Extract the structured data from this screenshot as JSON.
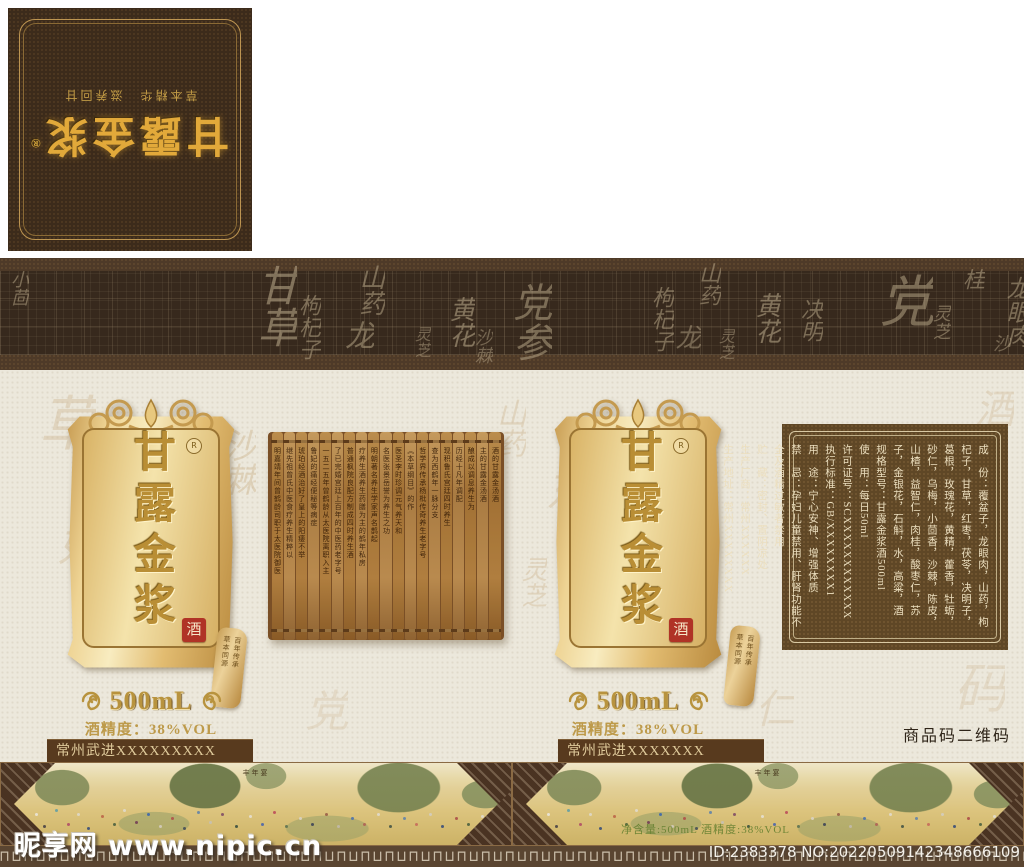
{
  "palette": {
    "gold": "#d2a347",
    "flap_brown": "#3c2b1b",
    "band_brown": "#4e3a28",
    "cream": "#ece8dc",
    "bar_brown": "#583a1e",
    "spec_brown": "#5f4726",
    "seal_red": "#b03326"
  },
  "top_flap": {
    "title": "甘露金浆",
    "registered": "®",
    "subtitle": "草本精华　滋养回甘"
  },
  "heritage": {
    "chars": [
      "百",
      "年",
      "传",
      "承"
    ],
    "subtext": "始于一六〇〇年",
    "seal": "鹤年堂"
  },
  "band_chars": [
    {
      "t": "小茴",
      "x": 6,
      "y": 12,
      "s": 18,
      "o": 0.5
    },
    {
      "t": "甘草",
      "x": 244,
      "y": 6,
      "s": 42,
      "o": 0.55
    },
    {
      "t": "枸杞子",
      "x": 292,
      "y": 36,
      "s": 22,
      "o": 0.5
    },
    {
      "t": "山药",
      "x": 352,
      "y": 6,
      "s": 26,
      "o": 0.5
    },
    {
      "t": "龙",
      "x": 334,
      "y": 62,
      "s": 30,
      "o": 0.5
    },
    {
      "t": "灵芝",
      "x": 408,
      "y": 68,
      "s": 16,
      "o": 0.45
    },
    {
      "t": "黄花",
      "x": 442,
      "y": 38,
      "s": 26,
      "o": 0.55
    },
    {
      "t": "党参",
      "x": 500,
      "y": 24,
      "s": 40,
      "o": 0.5
    },
    {
      "t": "沙棘",
      "x": 470,
      "y": 70,
      "s": 18,
      "o": 0.45
    },
    {
      "t": "枸杞子",
      "x": 645,
      "y": 28,
      "s": 22,
      "o": 0.5
    },
    {
      "t": "山药",
      "x": 692,
      "y": 4,
      "s": 22,
      "o": 0.5
    },
    {
      "t": "龙",
      "x": 668,
      "y": 66,
      "s": 26,
      "o": 0.45
    },
    {
      "t": "灵芝",
      "x": 712,
      "y": 70,
      "s": 16,
      "o": 0.45
    },
    {
      "t": "黄花",
      "x": 748,
      "y": 34,
      "s": 26,
      "o": 0.55
    },
    {
      "t": "决明",
      "x": 794,
      "y": 40,
      "s": 22,
      "o": 0.5
    },
    {
      "t": "党",
      "x": 862,
      "y": 14,
      "s": 56,
      "o": 0.5
    },
    {
      "t": "灵芝",
      "x": 928,
      "y": 46,
      "s": 18,
      "o": 0.5
    },
    {
      "t": "桂",
      "x": 956,
      "y": 10,
      "s": 22,
      "o": 0.5
    },
    {
      "t": "龙眼肉",
      "x": 998,
      "y": 18,
      "s": 24,
      "o": 0.5
    },
    {
      "t": "沙",
      "x": 988,
      "y": 76,
      "s": 18,
      "o": 0.45
    }
  ],
  "main_chars": [
    {
      "t": "草",
      "x": 20,
      "y": 392,
      "s": 60,
      "o": 0.3
    },
    {
      "t": "好",
      "x": 44,
      "y": 520,
      "s": 46,
      "o": 0.28
    },
    {
      "t": "沙棘",
      "x": 212,
      "y": 428,
      "s": 34,
      "o": 0.35
    },
    {
      "t": "山药",
      "x": 486,
      "y": 398,
      "s": 30,
      "o": 0.3
    },
    {
      "t": "东",
      "x": 530,
      "y": 468,
      "s": 44,
      "o": 0.3
    },
    {
      "t": "灵芝",
      "x": 514,
      "y": 556,
      "s": 26,
      "o": 0.3
    },
    {
      "t": "党",
      "x": 290,
      "y": 688,
      "s": 44,
      "o": 0.22
    },
    {
      "t": "仁",
      "x": 742,
      "y": 688,
      "s": 40,
      "o": 0.25
    },
    {
      "t": "酒",
      "x": 962,
      "y": 388,
      "s": 40,
      "o": 0.25
    },
    {
      "t": "码",
      "x": 936,
      "y": 660,
      "s": 54,
      "o": 0.22
    }
  ],
  "plaque": {
    "title": "甘露金浆",
    "registered": "R",
    "seal": "酒"
  },
  "side_tag": {
    "col1": "百年传承",
    "col2": "草本同源"
  },
  "scroll_columns": [
    "明嘉靖年间曾鹤龄司职于太医院御医",
    "继先祖曾氏中医食疗养生精粹以",
    "琥珀经酒治好了皇上的阳痿不举",
    "鲁妃的痛经便秘等病症",
    "一五二五年曾鹤龄从太医院离职入主",
    "了已完婚宫廷上百年的中医药老字号",
    "普通枫院良配方制成四时养生酒",
    "疗养生酒养生药膳为主的鹤年私房",
    "明朝著名养生学家声名鹊起",
    "名医张景岳誉为养生之功",
    "医圣李时珍调元气养天和",
    "《本草纲目》的作",
    "哲学界传承杨枇传奇养生老字号",
    "查为西鹤年一脉分支",
    "现积鲁氏宫廷四时养生",
    "历经十凡年调配",
    "酿成以调息养生为",
    "主的甘露金汤酒",
    "酒的甘露金汤酒"
  ],
  "volume": {
    "text": "500mL",
    "alcohol": "酒精度：38%VOL"
  },
  "producer": {
    "left": "常州武进XXXXXXXXX",
    "right": "常州武进XXXXXXX"
  },
  "barcode_label": "商品码二维码",
  "spec_entries": [
    "成　份：覆盆子，龙眼肉，山药，枸杞子，甘草，红枣，茯苓，决明子，葛根，玫瑰花，黄精，藿香，牡蛎，砂仁，乌梅，小茴香，沙棘，陈皮，山楂，益智仁，肉桂，酸枣仁，苏子，金银花，石斛，水，高粱，酒",
    "规格型号：甘露金浆酒500ml",
    "使　用：每日50ml",
    "许可证号：SCXXXXXXXXXXXX",
    "执行标准：GB/XXXXXXXX1",
    "用　途：宁心安神、增强体质",
    "禁　忌：孕妇儿童禁用、肝肾功能不全及酒精过敏者禁用",
    "贮　藏：密封、置阴凉处",
    "生产厂商：常州XXXXXX",
    "生产地址：常州XXXXXXXX"
  ],
  "painting_panels": [
    {
      "title": "丰年宴",
      "net": ""
    },
    {
      "title": "丰年宴",
      "net": "净含量:500mL 酒精度:38%VOL"
    }
  ],
  "decor": {
    "meander": "⊓⊔⊓⊔⊓⊔⊓⊔⊓⊔⊓⊔⊓⊔⊓⊔⊓⊔⊓⊔⊓⊔⊓⊔⊓⊔⊓⊔⊓⊔⊓⊔⊓⊔⊓⊔⊓⊔⊓⊔⊓⊔⊓⊔⊓⊔⊓⊔⊓⊔⊓⊔⊓⊔⊓⊔⊓⊔⊓⊔⊓⊔⊓⊔⊓⊔⊓⊔⊓⊔⊓⊔⊓⊔⊓⊔⊓⊔⊓⊔⊓⊔⊓⊔⊓⊔⊓⊔⊓⊔⊓⊔⊓⊔⊓⊔"
  },
  "watermark": {
    "site_line": "昵享网 www.nipic.cn",
    "id_line": "ID:2383378 NO:20220509142348666109"
  }
}
